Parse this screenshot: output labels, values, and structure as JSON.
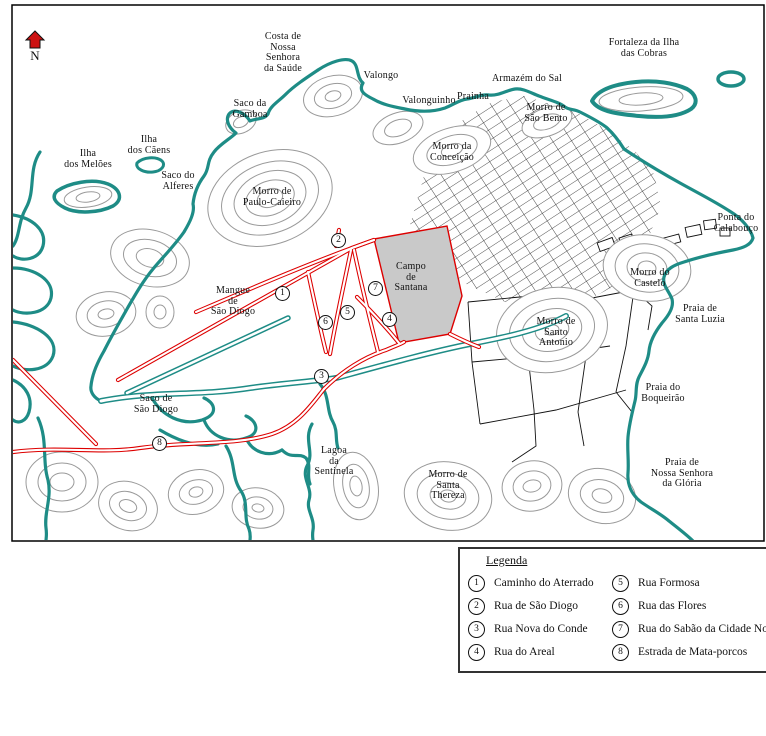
{
  "compass": {
    "label": "N"
  },
  "colors": {
    "coastline": "#1e8c86",
    "road": "#dd0000",
    "contour": "#9a9a9a",
    "campo_fill": "#c9c9c9",
    "north_arrow": "#cc1111"
  },
  "map_labels": {
    "costa_saude": "Costa de\nNossa\nSenhora\nda Saúde",
    "valongo": "Valongo",
    "valonguinho": "Valonguinho",
    "armazem_sal": "Armazém do Sal",
    "prainha": "Prainha",
    "morro_sao_bento": "Morro de\nSão Bento",
    "fortaleza_cobras": "Fortaleza da Ilha\ndas Cobras",
    "saco_gamboa": "Saco da\nGamboa",
    "ilha_meloes": "Ilha\ndos Melões",
    "ilha_caens": "Ilha\ndos Cãens",
    "saco_alferes": "Saco do\nAlferes",
    "morro_paulo_caieiro": "Morro de\nPaulo-Caieiro",
    "morro_conceicao": "Morro da\nConceição",
    "ponta_calabouco": "Ponta do\nCalabouço",
    "morro_castelo": "Morro do\nCastelo",
    "praia_santa_luzia": "Praia de\nSanta Luzia",
    "morro_santo_antonio": "Morro de\nSanto\nAntonio",
    "praia_boqueirao": "Praia do\nBoqueirão",
    "praia_gloria": "Praia de\nNossa Senhora\nda Glória",
    "mangue_sao_diogo": "Mangue\nde\nSão Diogo",
    "saco_sao_diogo": "Saco de\nSão Diogo",
    "lagoa_sentinela": "Lagoa\nda\nSentinela",
    "morro_santa_thereza": "Morro de\nSanta\nThereza",
    "campo_santana": "Campo\nde\nSantana"
  },
  "legend": {
    "title": "Legenda",
    "items": [
      {
        "num": "1",
        "label": "Caminho do Aterrado"
      },
      {
        "num": "2",
        "label": "Rua de São Diogo"
      },
      {
        "num": "3",
        "label": "Rua Nova do Conde"
      },
      {
        "num": "4",
        "label": "Rua do Areal"
      },
      {
        "num": "5",
        "label": "Rua Formosa"
      },
      {
        "num": "6",
        "label": "Rua das Flores"
      },
      {
        "num": "7",
        "label": "Rua do Sabão da Cidade Nova"
      },
      {
        "num": "8",
        "label": "Estrada de Mata-porcos"
      }
    ]
  }
}
